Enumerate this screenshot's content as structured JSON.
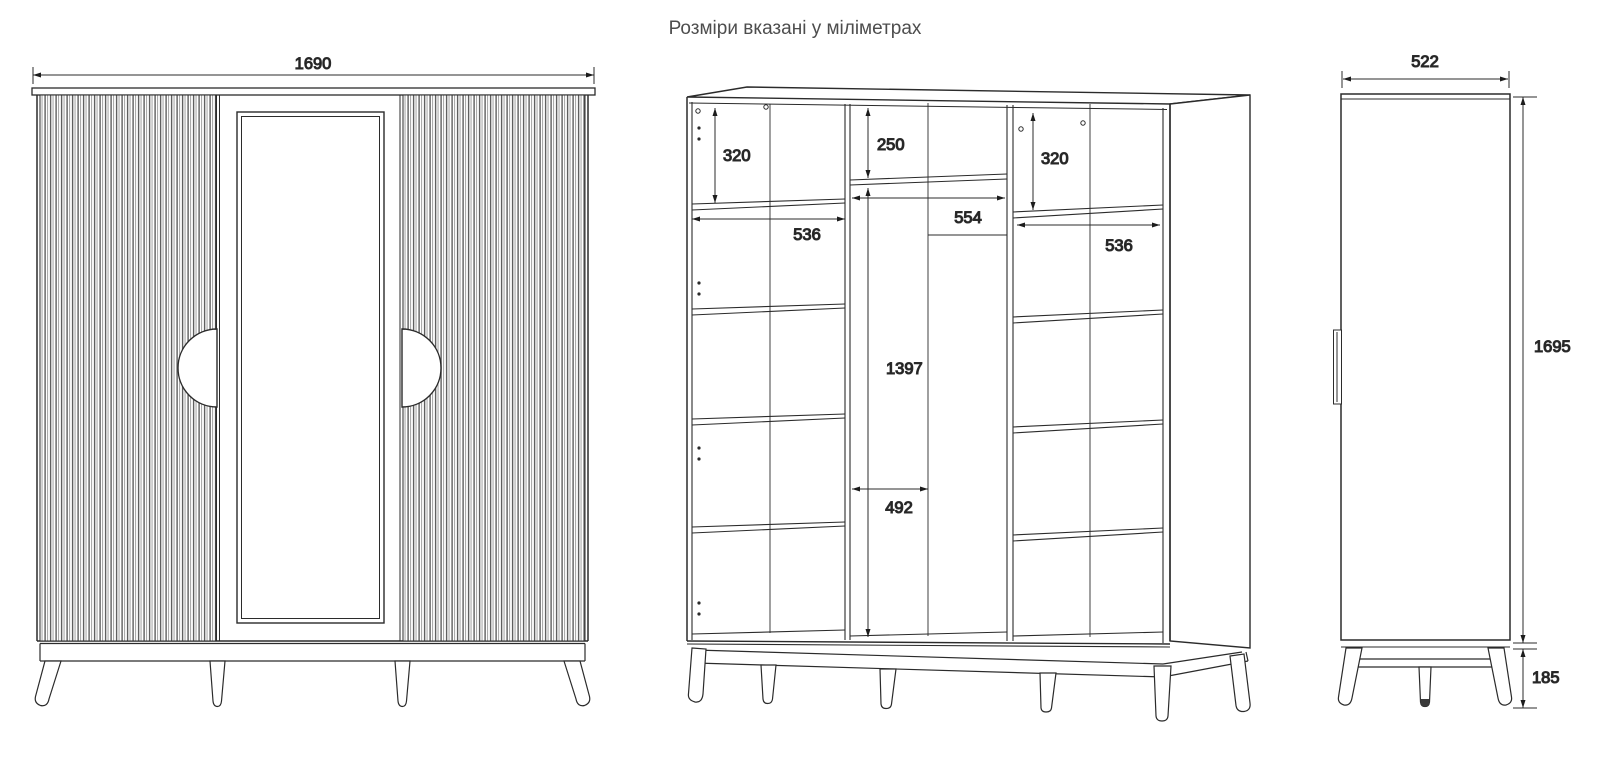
{
  "title": "Розміри вказані у міліметрах",
  "front_view": {
    "width_mm": "1690"
  },
  "internal_view": {
    "left_top_gap_mm": "320",
    "middle_top_gap_mm": "250",
    "right_top_gap_mm": "320",
    "left_shelf_width_mm": "536",
    "middle_top_width_mm": "554",
    "right_shelf_width_mm": "536",
    "hanging_height_mm": "1397",
    "hanging_width_mm": "492"
  },
  "side_view": {
    "depth_mm": "522",
    "body_height_mm": "1695",
    "leg_height_mm": "185"
  },
  "colors": {
    "line": "#2b2b2b",
    "dim_text": "#1c1c1c",
    "title_text": "#4d4d4d",
    "flute_dark": "#5f5f5f",
    "flute_light": "#ababab"
  }
}
